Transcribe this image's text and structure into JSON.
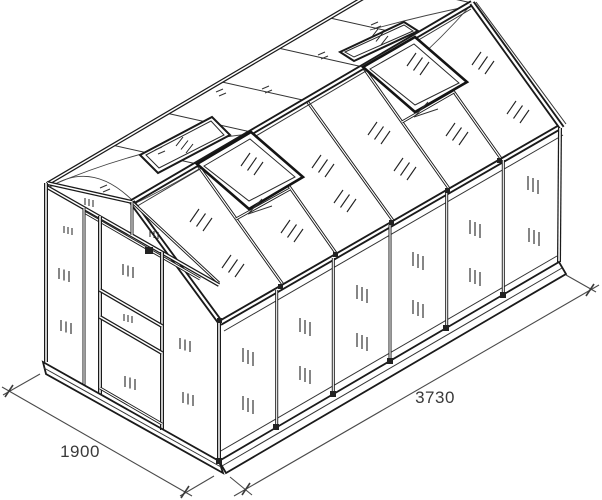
{
  "drawing": {
    "subject": "Greenhouse technical line drawing",
    "view": "isometric front-left",
    "background": "#ffffff",
    "line_color": "#1a1a1a",
    "dimension_text_color": "#3a3a3a",
    "dimensions": {
      "front_width": "1900",
      "side_length": "3730"
    },
    "features": {
      "side_wall_panels": 6,
      "roof_vents_open": 4,
      "door": "sliding door on gable end"
    }
  }
}
